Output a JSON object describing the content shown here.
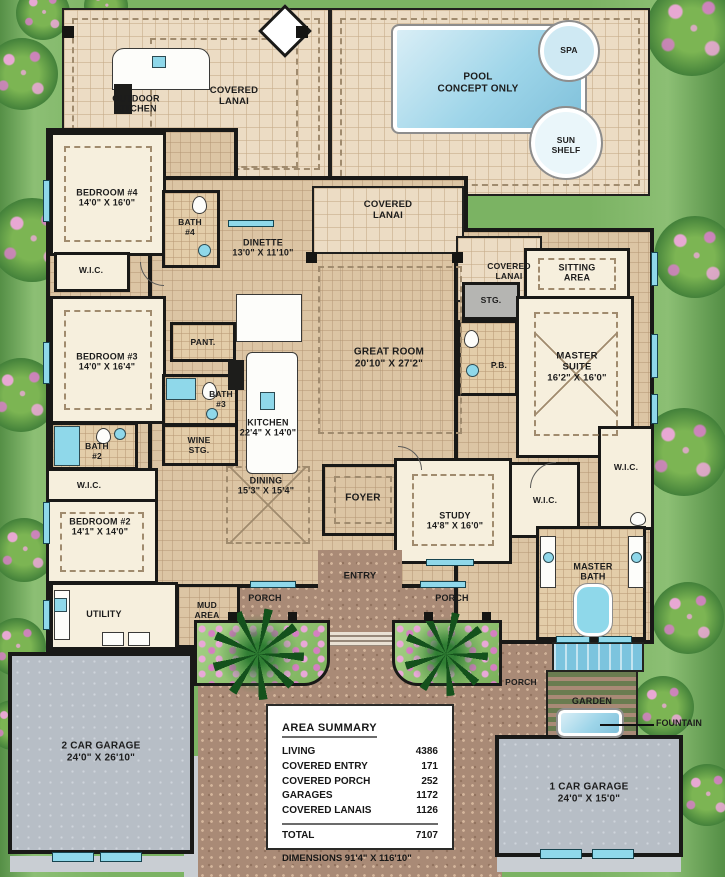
{
  "plan_labels": {
    "outdoor_kitchen": "OUTDOOR\nKITCHEN",
    "covered_lanai_top": "COVERED\nLANAI",
    "covered_lanai_mid": "COVERED\nLANAI",
    "covered_lanai_right": "COVERED\nLANAI",
    "pool": "POOL\nCONCEPT ONLY",
    "spa": "SPA",
    "sun_shelf": "SUN\nSHELF",
    "bedroom4": "BEDROOM #4\n14'0\" X 16'0\"",
    "bath4": "BATH\n#4",
    "wic_bed4": "W.I.C.",
    "dinette": "DINETTE\n13'0\" X 11'10\"",
    "sitting_area": "SITTING\nAREA",
    "stg": "STG.",
    "master_suite": "MASTER\nSUITE\n16'2\" X 16'0\"",
    "pb": "P.B.",
    "bedroom3": "BEDROOM #3\n14'0\" X 16'4\"",
    "pant": "PANT.",
    "bath3": "BATH\n#3",
    "great_room": "GREAT ROOM\n20'10\" X 27'2\"",
    "kitchen": "KITCHEN\n22'4\" X 14'0\"",
    "bath2": "BATH\n#2",
    "wine_stg": "WINE\nSTG.",
    "wic_bed2": "W.I.C.",
    "bedroom2": "BEDROOM #2\n14'1\" X 14'0\"",
    "dining": "DINING\n15'3\" X 15'4\"",
    "foyer": "FOYER",
    "study": "STUDY\n14'8\" X 16'0\"",
    "wic_master_left": "W.I.C.",
    "wic_master_right": "W.I.C.",
    "master_bath": "MASTER\nBATH",
    "utility": "UTILITY",
    "mud_area": "MUD\nAREA",
    "entry": "ENTRY",
    "porch_left": "PORCH",
    "porch_right": "PORCH",
    "porch_rear": "PORCH",
    "garden": "GARDEN",
    "fountain": "FOUNTAIN",
    "garage_2car": "2 CAR GARAGE\n24'0\" X 26'10\"",
    "garage_1car": "1 CAR GARAGE\n24'0\" X 15'0\""
  },
  "summary": {
    "title": "AREA SUMMARY",
    "rows": [
      {
        "name": "LIVING",
        "value": "4386"
      },
      {
        "name": "COVERED ENTRY",
        "value": "171"
      },
      {
        "name": "COVERED PORCH",
        "value": "252"
      },
      {
        "name": "GARAGES",
        "value": "1172"
      },
      {
        "name": "COVERED LANAIS",
        "value": "1126"
      }
    ],
    "total_name": "TOTAL",
    "total_value": "7107",
    "dimensions": "DIMENSIONS 91'4\" X 116'10\""
  },
  "colors": {
    "wall": "#191917",
    "deck_tile": "#ecdcc4",
    "interior_tile": "#dcc5a4",
    "carpet": "#f6efdd",
    "bath_tile": "#e3cda9",
    "brick_paving": "#a98a76",
    "garage_floor": "#b7bec6",
    "pool_water": "#9ed5e9",
    "window_glass": "#8fd8ea",
    "grass": "#7bb363",
    "flower_pink": "#d57fc2"
  }
}
